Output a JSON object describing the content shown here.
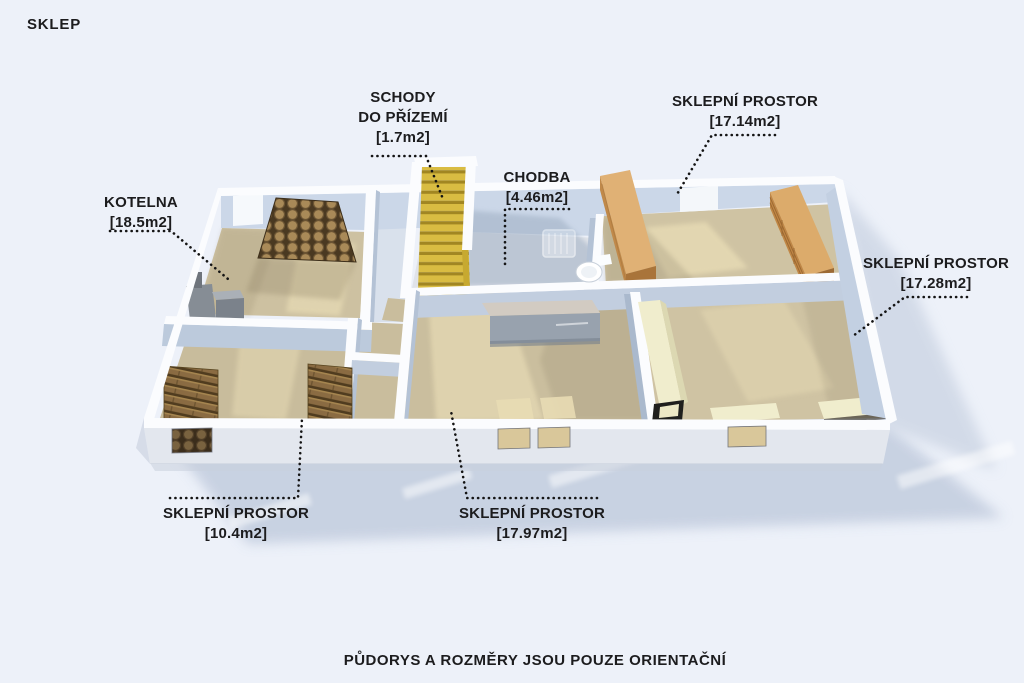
{
  "title": "SKLEP",
  "footer": "PŮDORYS A ROZMĚRY JSOU POUZE ORIENTAČNÍ",
  "labels": {
    "kotelna": {
      "name": "KOTELNA",
      "area": "[18.5m2]"
    },
    "schody": {
      "name_line1": "SCHODY",
      "name_line2": "DO PŘÍZEMÍ",
      "area": "[1.7m2]"
    },
    "chodba": {
      "name": "CHODBA",
      "area": "[4.46m2]"
    },
    "sklep_17_14": {
      "name": "SKLEPNÍ PROSTOR",
      "area": "[17.14m2]"
    },
    "sklep_17_28": {
      "name": "SKLEPNÍ PROSTOR",
      "area": "[17.28m2]"
    },
    "sklep_10_4": {
      "name": "SKLEPNÍ PROSTOR",
      "area": "[10.4m2]"
    },
    "sklep_17_97": {
      "name": "SKLEPNÍ PROSTOR",
      "area": "[17.97m2]"
    }
  },
  "colors": {
    "background": "#edf1f9",
    "text": "#1c1c1e",
    "floor": "#cdc1a1",
    "floor_light": "#e6dab4",
    "wall_top": "#fbfcfe",
    "wall_face": "#c9d6e7",
    "exterior_wall": "#e3e7ee",
    "ground_shadow": "#c5cfe0",
    "stairs": "#d9bc42",
    "wood": "#c08746",
    "workbench": "#f0edcd",
    "logs": "#a98a58"
  }
}
